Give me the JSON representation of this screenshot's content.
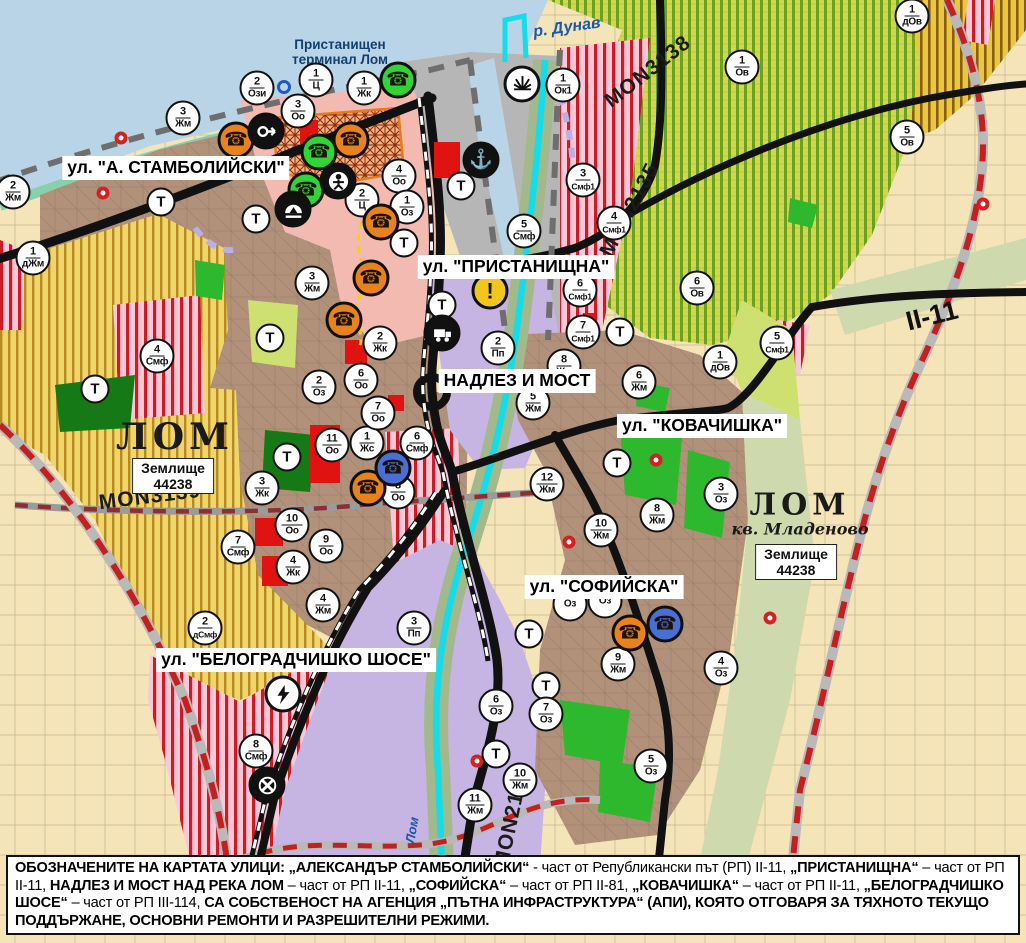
{
  "title": "Устройствен план – гр. Лом",
  "colors": {
    "water": "#b9d4e6",
    "shore": "#86d1ab",
    "beige": "#f4e4b8",
    "vine_base": "#d8d44e",
    "vine_stripe": "#64a51f",
    "dov_base": "#eac73e",
    "dov_stripe": "#8a6010",
    "yellow_base": "#f2d569",
    "yellow_stripe": "#a87d18",
    "brown": "#b2917a",
    "pink": "#f3bab2",
    "smf_base": "#f5c9d8",
    "smf_stripe": "#cf1a26",
    "purple": "#c6b4e2",
    "gray": "#b6b6b6",
    "sage": "#cfd9ae",
    "light_green": "#cde070",
    "green": "#2eb82e",
    "dark_green": "#157a15",
    "cyan": "#14dce8",
    "road": "#111111",
    "red_dash": "#c42020",
    "orange": "#e8821e",
    "poi_green": "#2fd435",
    "poi_blue": "#4a6fd4",
    "poi_black": "#111111",
    "poi_yellow": "#f2c71d",
    "poi_white": "#ffffff"
  },
  "map": {
    "water_labels": [
      {
        "text": "р. Дунав",
        "x": 567,
        "y": 28,
        "rot": -8,
        "cls": "wlbl",
        "size": 16
      },
      {
        "text": "Лом",
        "x": 412,
        "y": 830,
        "rot": -80,
        "cls": "wlbl",
        "size": 13
      }
    ],
    "terminal_label": {
      "line1": "Пристанищен",
      "line2": "терминал Лом",
      "x": 340,
      "y": 52
    },
    "road_labels": [
      {
        "text": "MON3138",
        "x": 648,
        "y": 72,
        "rot": -38,
        "cls": "mon"
      },
      {
        "text": "MON2135",
        "x": 630,
        "y": 210,
        "rot": -62,
        "cls": "mon"
      },
      {
        "text": "MON3139",
        "x": 150,
        "y": 497,
        "rot": -7,
        "cls": "mon"
      },
      {
        "text": "MON2136",
        "x": 512,
        "y": 818,
        "rot": -78,
        "cls": "mon"
      },
      {
        "text": "II-11",
        "x": 932,
        "y": 316,
        "rot": -14,
        "cls": "rdno"
      }
    ],
    "street_labels": [
      {
        "text": "ул. \"А. СТАМБОЛИЙСКИ\"",
        "x": 176,
        "y": 168
      },
      {
        "text": "ул. \"ПРИСТАНИЩНА\"",
        "x": 516,
        "y": 267
      },
      {
        "text": "НАДЛЕЗ И МОСТ",
        "x": 517,
        "y": 381
      },
      {
        "text": "ул. \"КОВАЧИШКА\"",
        "x": 702,
        "y": 426
      },
      {
        "text": "ул. \"СОФИЙСКА\"",
        "x": 604,
        "y": 587
      },
      {
        "text": "ул. \"БЕЛОГРАДЧИШКО ШОСЕ\"",
        "x": 296,
        "y": 660
      }
    ],
    "city1": {
      "name": "ЛОМ",
      "x": 175,
      "y": 437,
      "size": 36
    },
    "city1_zem": {
      "line1": "Землище",
      "line2": "44238",
      "x": 173,
      "y": 476
    },
    "city2": {
      "name": "ЛОМ",
      "x": 800,
      "y": 505,
      "size": 30
    },
    "city2_kv": {
      "name": "кв. Младеново",
      "x": 800,
      "y": 529
    },
    "city2_zem": {
      "line1": "Землище",
      "line2": "44238",
      "x": 796,
      "y": 562
    },
    "zone_markers": [
      {
        "x": 13,
        "y": 192,
        "n": "2",
        "c": "Жм"
      },
      {
        "x": 183,
        "y": 118,
        "n": "3",
        "c": "Жм"
      },
      {
        "x": 257,
        "y": 88,
        "n": "2",
        "c": "Ози"
      },
      {
        "x": 316,
        "y": 80,
        "n": "1",
        "c": "Ц"
      },
      {
        "x": 298,
        "y": 111,
        "n": "3",
        "c": "Оо"
      },
      {
        "x": 364,
        "y": 88,
        "n": "1",
        "c": "Жк"
      },
      {
        "x": 563,
        "y": 85,
        "n": "1",
        "c": "Ок1"
      },
      {
        "x": 399,
        "y": 176,
        "n": "4",
        "c": "Оо"
      },
      {
        "x": 362,
        "y": 200,
        "n": "2",
        "c": "Ц"
      },
      {
        "x": 407,
        "y": 207,
        "n": "1",
        "c": "Оз"
      },
      {
        "x": 524,
        "y": 231,
        "n": "5",
        "c": "Смф"
      },
      {
        "x": 583,
        "y": 180,
        "n": "3",
        "c": "Смф1"
      },
      {
        "x": 33,
        "y": 258,
        "n": "1",
        "c": "дЖм"
      },
      {
        "x": 312,
        "y": 283,
        "n": "3",
        "c": "Жм"
      },
      {
        "x": 742,
        "y": 67,
        "n": "1",
        "c": "Ов"
      },
      {
        "x": 912,
        "y": 16,
        "n": "1",
        "c": "дОв"
      },
      {
        "x": 907,
        "y": 137,
        "n": "5",
        "c": "Ов"
      },
      {
        "x": 697,
        "y": 288,
        "n": "6",
        "c": "Ов"
      },
      {
        "x": 777,
        "y": 343,
        "n": "5",
        "c": "Смф1"
      },
      {
        "x": 720,
        "y": 362,
        "n": "1",
        "c": "дОв"
      },
      {
        "x": 614,
        "y": 223,
        "n": "4",
        "c": "Смф1"
      },
      {
        "x": 580,
        "y": 290,
        "n": "6",
        "c": "Смф1"
      },
      {
        "x": 583,
        "y": 332,
        "n": "7",
        "c": "Смф1"
      },
      {
        "x": 564,
        "y": 366,
        "n": "8",
        "c": "Жм"
      },
      {
        "x": 533,
        "y": 403,
        "n": "5",
        "c": "Жм"
      },
      {
        "x": 547,
        "y": 484,
        "n": "12",
        "c": "Жм"
      },
      {
        "x": 601,
        "y": 530,
        "n": "10",
        "c": "Жм"
      },
      {
        "x": 657,
        "y": 515,
        "n": "8",
        "c": "Жм"
      },
      {
        "x": 721,
        "y": 494,
        "n": "3",
        "c": "Оз"
      },
      {
        "x": 639,
        "y": 382,
        "n": "6",
        "c": "Жм"
      },
      {
        "x": 618,
        "y": 664,
        "n": "9",
        "c": "Жм"
      },
      {
        "x": 721,
        "y": 668,
        "n": "4",
        "c": "Оз"
      },
      {
        "x": 651,
        "y": 766,
        "n": "5",
        "c": "Оз"
      },
      {
        "x": 496,
        "y": 706,
        "n": "6",
        "c": "Оз"
      },
      {
        "x": 546,
        "y": 714,
        "n": "7",
        "c": "Оз"
      },
      {
        "x": 520,
        "y": 780,
        "n": "10",
        "c": "Жм"
      },
      {
        "x": 475,
        "y": 805,
        "n": "11",
        "c": "Жм"
      },
      {
        "x": 319,
        "y": 387,
        "n": "2",
        "c": "Оз"
      },
      {
        "x": 332,
        "y": 445,
        "n": "11",
        "c": "Оо"
      },
      {
        "x": 367,
        "y": 443,
        "n": "1",
        "c": "Жс"
      },
      {
        "x": 417,
        "y": 443,
        "n": "6",
        "c": "Смф"
      },
      {
        "x": 378,
        "y": 413,
        "n": "7",
        "c": "Оо"
      },
      {
        "x": 361,
        "y": 380,
        "n": "6",
        "c": "Оо"
      },
      {
        "x": 380,
        "y": 343,
        "n": "2",
        "c": "Жк"
      },
      {
        "x": 398,
        "y": 492,
        "n": "8",
        "c": "Оо"
      },
      {
        "x": 262,
        "y": 488,
        "n": "3",
        "c": "Жк"
      },
      {
        "x": 292,
        "y": 525,
        "n": "10",
        "c": "Оо"
      },
      {
        "x": 326,
        "y": 546,
        "n": "9",
        "c": "Оо"
      },
      {
        "x": 238,
        "y": 547,
        "n": "7",
        "c": "Смф"
      },
      {
        "x": 293,
        "y": 567,
        "n": "4",
        "c": "Жк"
      },
      {
        "x": 323,
        "y": 605,
        "n": "4",
        "c": "Жм"
      },
      {
        "x": 205,
        "y": 628,
        "n": "2",
        "c": "дСмф"
      },
      {
        "x": 414,
        "y": 628,
        "n": "3",
        "c": "Пп"
      },
      {
        "x": 256,
        "y": 751,
        "n": "8",
        "c": "Смф"
      },
      {
        "x": 498,
        "y": 348,
        "n": "2",
        "c": "Пп"
      },
      {
        "x": 157,
        "y": 356,
        "n": "4",
        "c": "Смф"
      },
      {
        "x": 570,
        "y": 604,
        "n": "",
        "c": "Оз"
      },
      {
        "x": 605,
        "y": 601,
        "n": "",
        "c": "Оз"
      }
    ],
    "t_markers": [
      {
        "x": 461,
        "y": 186
      },
      {
        "x": 442,
        "y": 305
      },
      {
        "x": 404,
        "y": 243
      },
      {
        "x": 256,
        "y": 219
      },
      {
        "x": 161,
        "y": 202
      },
      {
        "x": 95,
        "y": 389
      },
      {
        "x": 270,
        "y": 338
      },
      {
        "x": 287,
        "y": 457
      },
      {
        "x": 529,
        "y": 634
      },
      {
        "x": 546,
        "y": 686
      },
      {
        "x": 496,
        "y": 754
      },
      {
        "x": 620,
        "y": 332
      },
      {
        "x": 617,
        "y": 463
      }
    ],
    "poi_markers": [
      {
        "x": 236,
        "y": 140,
        "icon": "telephone-icon",
        "bg": "orange"
      },
      {
        "x": 351,
        "y": 140,
        "icon": "telephone-icon",
        "bg": "orange"
      },
      {
        "x": 381,
        "y": 222,
        "icon": "telephone-icon",
        "bg": "orange"
      },
      {
        "x": 371,
        "y": 278,
        "icon": "telephone-icon",
        "bg": "orange"
      },
      {
        "x": 344,
        "y": 320,
        "icon": "telephone-icon",
        "bg": "orange"
      },
      {
        "x": 368,
        "y": 488,
        "icon": "telephone-icon",
        "bg": "orange"
      },
      {
        "x": 630,
        "y": 633,
        "icon": "telephone-icon",
        "bg": "orange"
      },
      {
        "x": 398,
        "y": 80,
        "icon": "telephone-icon",
        "bg": "poi_green"
      },
      {
        "x": 319,
        "y": 152,
        "icon": "telephone-icon",
        "bg": "poi_green"
      },
      {
        "x": 306,
        "y": 190,
        "icon": "telephone-icon",
        "bg": "poi_green"
      },
      {
        "x": 393,
        "y": 468,
        "icon": "telephone-icon",
        "bg": "poi_blue"
      },
      {
        "x": 665,
        "y": 624,
        "icon": "telephone-icon",
        "bg": "poi_blue"
      },
      {
        "x": 266,
        "y": 131,
        "icon": "arrow-icon",
        "bg": "poi_black"
      },
      {
        "x": 338,
        "y": 181,
        "icon": "person-monument-icon",
        "bg": "poi_black"
      },
      {
        "x": 293,
        "y": 209,
        "icon": "cave-icon",
        "bg": "poi_black"
      },
      {
        "x": 442,
        "y": 333,
        "icon": "truck-icon",
        "bg": "poi_black"
      },
      {
        "x": 481,
        "y": 160,
        "icon": "anchor-icon",
        "bg": "poi_black"
      },
      {
        "x": 490,
        "y": 291,
        "icon": "exclamation-icon",
        "bg": "poi_yellow"
      },
      {
        "x": 522,
        "y": 84,
        "icon": "sun-fan-icon",
        "bg": "poi_white"
      },
      {
        "x": 283,
        "y": 694,
        "icon": "lightning-icon",
        "bg": "poi_white"
      },
      {
        "x": 267,
        "y": 785,
        "icon": "rail-crossing-icon",
        "bg": "poi_black"
      }
    ],
    "dot_markers": [
      {
        "x": 121,
        "y": 138
      },
      {
        "x": 103,
        "y": 193
      },
      {
        "x": 983,
        "y": 204
      },
      {
        "x": 569,
        "y": 542
      },
      {
        "x": 656,
        "y": 460
      },
      {
        "x": 477,
        "y": 761
      },
      {
        "x": 770,
        "y": 618
      }
    ],
    "ring_markers": [
      {
        "x": 284,
        "y": 87
      }
    ]
  },
  "caption": {
    "segments": [
      {
        "b": 1,
        "t": "ОБОЗНАЧЕНИТЕ НА КАРТАТА УЛИЦИ: „АЛЕКСАНДЪР СТАМБОЛИЙСКИ“"
      },
      {
        "b": 0,
        "t": " - част от Републикански път (РП) II-11, "
      },
      {
        "b": 1,
        "t": "„ПРИСТАНИЩНА“"
      },
      {
        "b": 0,
        "t": " – част от РП II-11, "
      },
      {
        "b": 1,
        "t": "НАДЛЕЗ И МОСТ НАД РЕКА ЛОМ"
      },
      {
        "b": 0,
        "t": " – част от РП II-11, "
      },
      {
        "b": 1,
        "t": "„СОФИЙСКА“"
      },
      {
        "b": 0,
        "t": " – част от РП II-81, "
      },
      {
        "b": 1,
        "t": "„КОВАЧИШКА“"
      },
      {
        "b": 0,
        "t": " – част от РП II-11, "
      },
      {
        "b": 1,
        "t": "„БЕЛОГРАДЧИШКО ШОСЕ“"
      },
      {
        "b": 0,
        "t": " – част от РП III-114, "
      },
      {
        "b": 1,
        "t": "СА СОБСТВЕНОСТ НА АГЕНЦИЯ „ПЪТНА ИНФРАСТРУКТУРА“ (АПИ), КОЯТО ОТГОВАРЯ ЗА ТЯХНОТО ТЕКУЩО ПОДДЪРЖАНЕ, ОСНОВНИ РЕМОНТИ И РАЗРЕШИТЕЛНИ РЕЖИМИ."
      }
    ]
  }
}
